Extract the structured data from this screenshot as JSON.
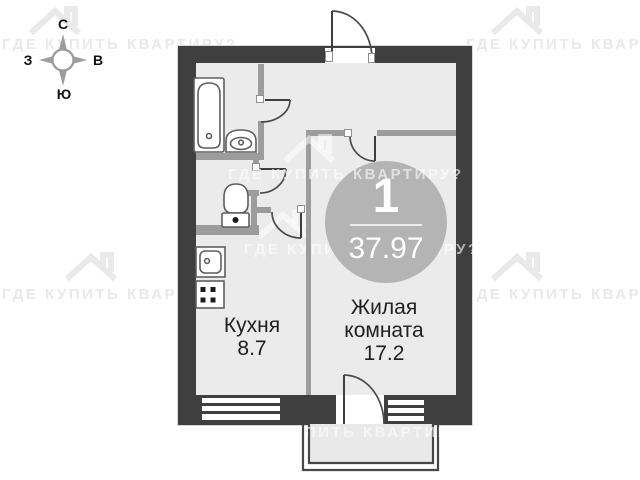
{
  "compass": {
    "north": "С",
    "east": "В",
    "south": "Ю",
    "west": "З"
  },
  "watermark": {
    "text": "ГДЕ КУПИТЬ КВАРТИРУ?"
  },
  "plan": {
    "badge": {
      "rooms_count": "1",
      "total_area": "37.97"
    },
    "rooms": [
      {
        "id": "kitchen",
        "name": "Кухня",
        "area": "8.7"
      },
      {
        "id": "living",
        "name": "Жилая комната",
        "area": "17.2"
      }
    ]
  },
  "colors": {
    "wall": "#3f3f3f",
    "partition": "#9c9c9c",
    "floor": "#ebebeb",
    "badge": "#b4b4b4",
    "watermark_gray": "#e9e9e9"
  }
}
